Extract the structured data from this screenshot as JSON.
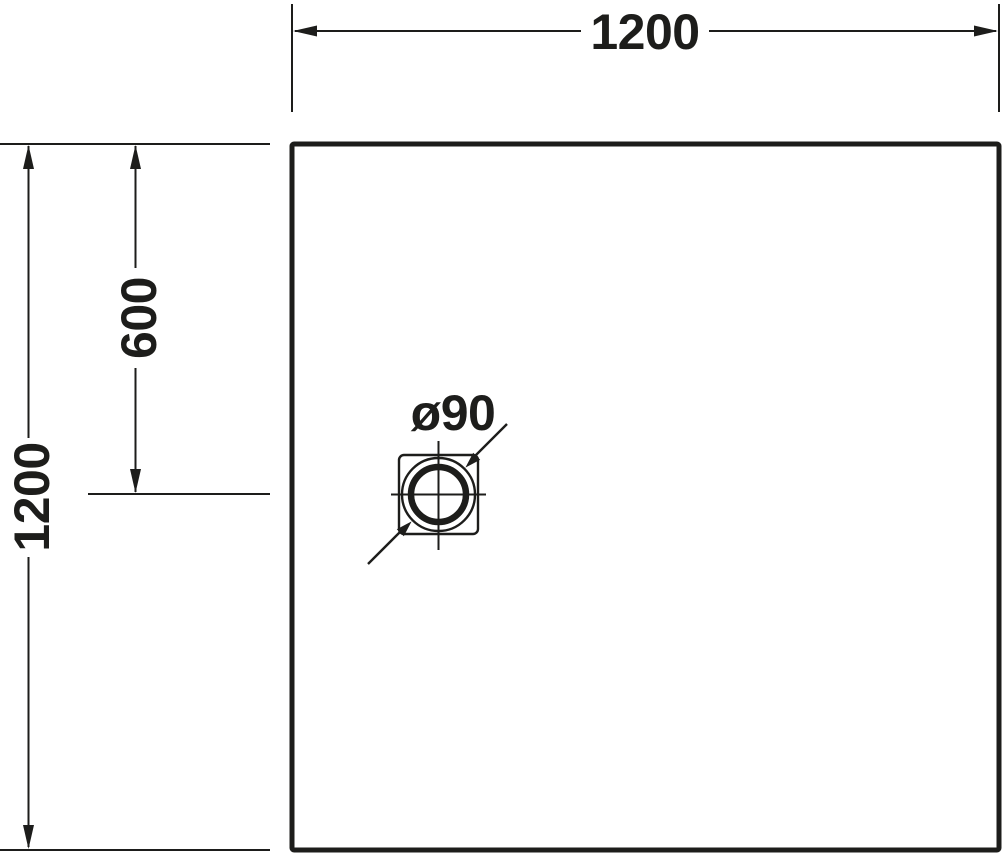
{
  "drawing": {
    "type": "technical-dimension-drawing",
    "subject": "square shower tray plan view with drain",
    "colors": {
      "line": "#1d1d1b",
      "background": "#ffffff"
    },
    "dimensions": {
      "overall_width": "1200",
      "overall_height": "1200",
      "drain_offset_from_top": "600",
      "drain_diameter": "ø90"
    }
  }
}
